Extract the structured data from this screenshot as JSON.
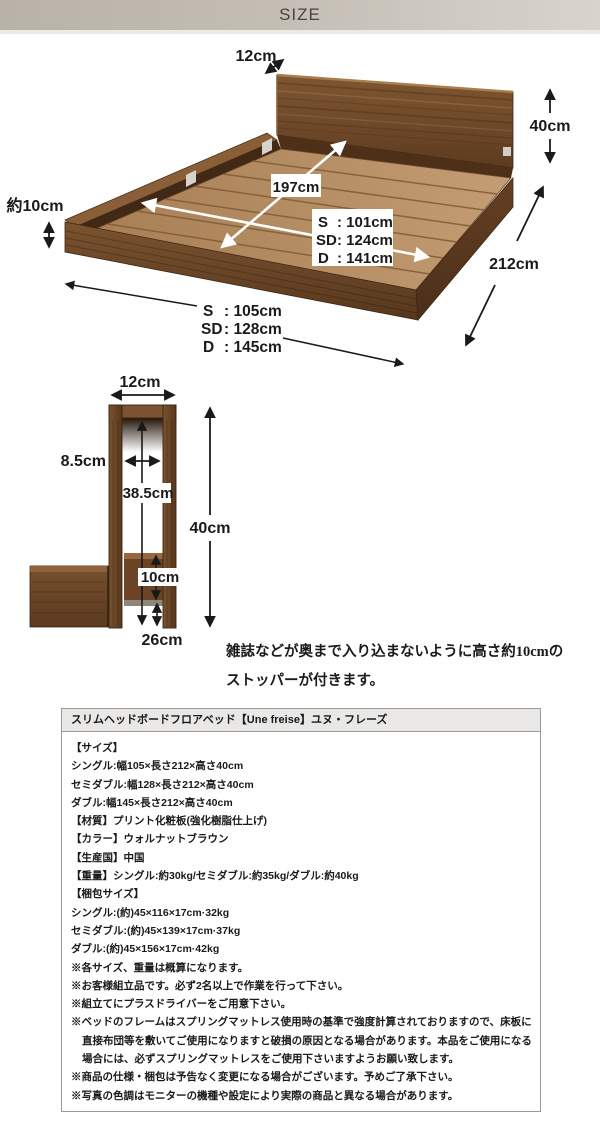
{
  "header": {
    "title": "SIZE"
  },
  "bed_diagram": {
    "headboard_thickness": "12cm",
    "height": "40cm",
    "inner_length": "197cm",
    "inner_width_rows": [
      {
        "k": "S",
        "v": ": 101cm"
      },
      {
        "k": "SD",
        "v": ": 124cm"
      },
      {
        "k": "D",
        "v": ": 141cm"
      }
    ],
    "frame_height": "約10cm",
    "outer_length": "212cm",
    "outer_width_rows": [
      {
        "k": "S",
        "v": ": 105cm"
      },
      {
        "k": "SD",
        "v": ": 128cm"
      },
      {
        "k": "D",
        "v": ": 145cm"
      }
    ]
  },
  "headboard_diagram": {
    "width": "12cm",
    "inner_width": "8.5cm",
    "inner_depth": "38.5cm",
    "height": "40cm",
    "stopper_height": "10cm",
    "bottom": "26cm",
    "caption_line1": "雑誌などが奥まで入り込まないように高さ約10cmの",
    "caption_line2": "ストッパーが付きます。"
  },
  "spec": {
    "title": "スリムヘッドボードフロアベッド【Une freise】ユヌ・フレーズ",
    "lines": [
      "【サイズ】",
      "シングル:幅105×長さ212×高さ40cm",
      "セミダブル:幅128×長さ212×高さ40cm",
      "ダブル:幅145×長さ212×高さ40cm",
      "【材質】プリント化粧板(強化樹脂仕上げ)",
      "【カラー】ウォルナットブラウン",
      "【生産国】中国",
      "【重量】シングル:約30kg/セミダブル:約35kg/ダブル:約40kg",
      "【梱包サイズ】",
      "シングル:(約)45×116×17cm·32kg",
      "セミダブル:(約)45×139×17cm·37kg",
      "ダブル:(約)45×156×17cm·42kg",
      "※各サイズ、重量は概算になります。",
      "※お客様組立品です。必ず2名以上で作業を行って下さい。",
      "※組立てにプラスドライバーをご用意下さい。",
      "※ベッドのフレームはスプリングマットレス使用時の基準で強度計算されておりますので、床板に",
      "直接布団等を敷いてご使用になりますと破損の原因となる場合があります。本品をご使用になる",
      "場合には、必ずスプリングマットレスをご使用下さいますようお願い致します。",
      "※商品の仕様・梱包は予告なく変更になる場合がございます。予めご了承下さい。",
      "※写真の色調はモニターの機種や設定により実際の商品と異なる場合があります。"
    ]
  },
  "colors": {
    "walnut_dark": "#5e3c20",
    "walnut_mid": "#7b5330",
    "deck_tan": "#b48c63",
    "header_band": "#c3bdb4"
  }
}
